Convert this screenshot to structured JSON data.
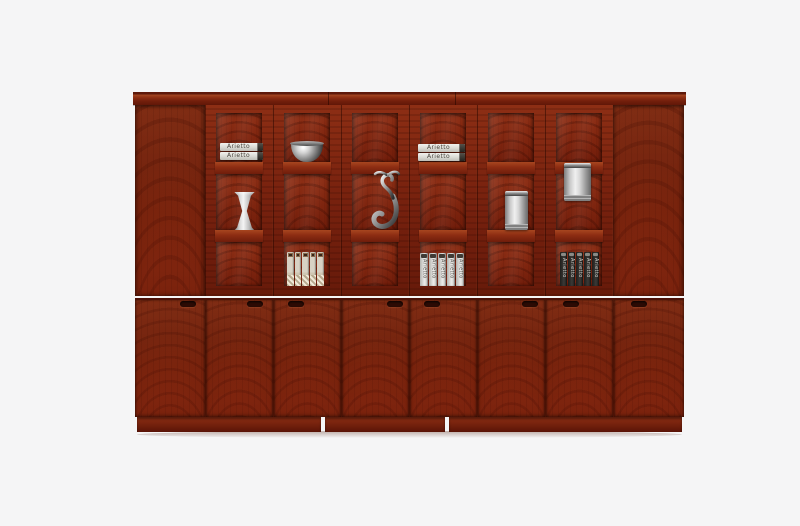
{
  "photo": {
    "subject": "Red-brown mahogany veneer office bookcase with glass display doors, product photo on plain light background",
    "background_color": "#f5f5f6",
    "colors": {
      "wood_base": "#8a2a14",
      "wood_frame": "#77210e",
      "wood_back_panel": "#7d250f",
      "molding": "#731f0c",
      "plinth": "#72200c",
      "seam_line": "#4d1208",
      "metal_silver": "#c9c9c9",
      "handle_slot": "#2c0b04"
    }
  },
  "structure": {
    "crown_molding": "single top molding strip with two unit seams",
    "upper_solid_doors": 2,
    "glass_door_count": 6,
    "panes_per_glass_door": 3,
    "lower_door_count": 8,
    "handle_count": 8,
    "plinth_segments": 3
  },
  "shelf_items": {
    "book_stack": {
      "label": "Arietto",
      "count": 2,
      "description": "two white books lying flat with metal clasps"
    },
    "bowl": {
      "description": "polished silver bowl"
    },
    "vase": {
      "description": "silver hourglass-shaped vase"
    },
    "sculpture": {
      "description": "abstract pewter figurine with sweeping hook base"
    },
    "canister_small": {
      "description": "brushed steel canister"
    },
    "canister_large": {
      "description": "brushed steel canister with lid"
    },
    "binders_light": {
      "count": 5,
      "description": "beige woven-pattern file boxes with dark label chips"
    },
    "binders_white": {
      "label": "Arietto",
      "count": 5,
      "description": "white upright binders with spine titles"
    },
    "binders_dark": {
      "label": "Arietto",
      "count": 5,
      "description": "black upright binders with spine titles"
    }
  }
}
